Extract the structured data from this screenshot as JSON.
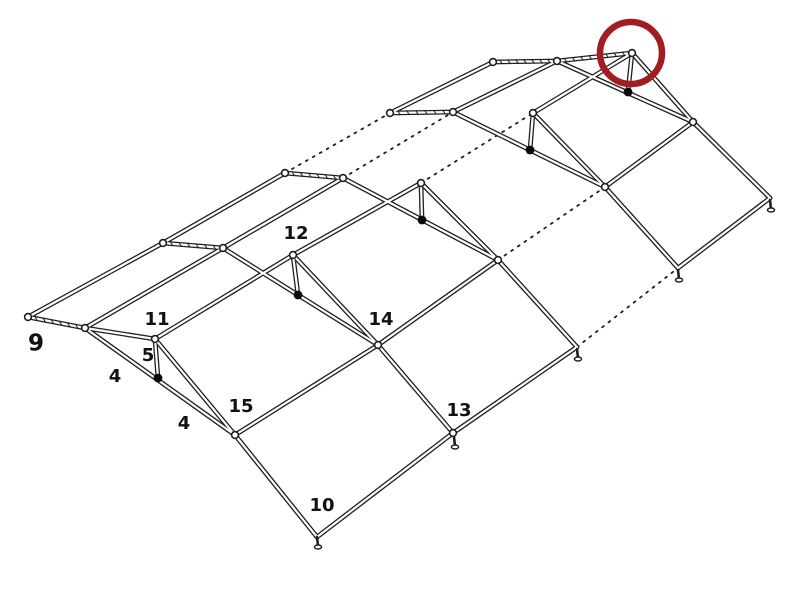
{
  "page": {
    "background": "#ffffff"
  },
  "diagram": {
    "type": "line-drawing",
    "description": "isometric assembly diagram of a pipe-frame tent skeleton with numbered part callouts and a red highlight circle on the far end fitting",
    "canvas": {
      "width": 800,
      "height": 600
    },
    "colors": {
      "line": "#1f1f1f",
      "pipe_core": "#ffffff",
      "connector_dot": "#0a0a0a",
      "label_text": "#111111",
      "highlight": "#a21d23",
      "background": "#ffffff"
    },
    "highlight_circle": {
      "cx": 631,
      "cy": 53,
      "r": 31,
      "stroke_width": 6.5
    },
    "part_labels": [
      {
        "text": "9",
        "x": 36,
        "y": 344,
        "size": 23
      },
      {
        "text": "11",
        "x": 157,
        "y": 320,
        "size": 18
      },
      {
        "text": "5",
        "x": 148,
        "y": 356,
        "size": 18
      },
      {
        "text": "4",
        "x": 115,
        "y": 377,
        "size": 18
      },
      {
        "text": "4",
        "x": 184,
        "y": 424,
        "size": 18
      },
      {
        "text": "15",
        "x": 241,
        "y": 407,
        "size": 18
      },
      {
        "text": "12",
        "x": 296,
        "y": 234,
        "size": 18
      },
      {
        "text": "14",
        "x": 381,
        "y": 320,
        "size": 18
      },
      {
        "text": "13",
        "x": 459,
        "y": 411,
        "size": 18
      },
      {
        "text": "10",
        "x": 322,
        "y": 506,
        "size": 18
      }
    ],
    "segments": [
      {
        "name": "back-eave-bay1",
        "x1": 28,
        "y1": 317,
        "x2": 163,
        "y2": 243,
        "style": "solid",
        "hatch": false
      },
      {
        "name": "back-eave-bay2",
        "x1": 163,
        "y1": 243,
        "x2": 285,
        "y2": 173,
        "style": "solid",
        "hatch": false
      },
      {
        "name": "back-eave-bay3",
        "x1": 285,
        "y1": 173,
        "x2": 390,
        "y2": 113,
        "style": "dotted",
        "hatch": false
      },
      {
        "name": "back-eave-bay4",
        "x1": 390,
        "y1": 113,
        "x2": 493,
        "y2": 62,
        "style": "solid",
        "hatch": false
      },
      {
        "name": "ridge-bay1",
        "x1": 85,
        "y1": 328,
        "x2": 223,
        "y2": 248,
        "style": "solid",
        "hatch": false
      },
      {
        "name": "ridge-bay2",
        "x1": 223,
        "y1": 248,
        "x2": 343,
        "y2": 178,
        "style": "solid",
        "hatch": false
      },
      {
        "name": "ridge-bay3",
        "x1": 343,
        "y1": 178,
        "x2": 453,
        "y2": 112,
        "style": "dotted",
        "hatch": false
      },
      {
        "name": "ridge-bay4",
        "x1": 453,
        "y1": 112,
        "x2": 557,
        "y2": 61,
        "style": "solid",
        "hatch": false
      },
      {
        "name": "purlin-bay1",
        "x1": 155,
        "y1": 339,
        "x2": 293,
        "y2": 255,
        "style": "solid",
        "hatch": false
      },
      {
        "name": "purlin-bay2",
        "x1": 293,
        "y1": 255,
        "x2": 421,
        "y2": 183,
        "style": "solid",
        "hatch": false
      },
      {
        "name": "purlin-bay3",
        "x1": 421,
        "y1": 183,
        "x2": 533,
        "y2": 113,
        "style": "dotted",
        "hatch": false
      },
      {
        "name": "purlin-bay4",
        "x1": 533,
        "y1": 113,
        "x2": 632,
        "y2": 53,
        "style": "solid",
        "hatch": false
      },
      {
        "name": "eave-girt-bay1",
        "x1": 235,
        "y1": 435,
        "x2": 378,
        "y2": 345,
        "style": "solid",
        "hatch": false
      },
      {
        "name": "eave-girt-bay2",
        "x1": 378,
        "y1": 345,
        "x2": 498,
        "y2": 260,
        "style": "solid",
        "hatch": false
      },
      {
        "name": "eave-girt-bay3",
        "x1": 498,
        "y1": 260,
        "x2": 605,
        "y2": 187,
        "style": "dotted",
        "hatch": false
      },
      {
        "name": "eave-girt-bay4",
        "x1": 605,
        "y1": 187,
        "x2": 693,
        "y2": 122,
        "style": "solid",
        "hatch": false
      },
      {
        "name": "foot-line-bay1",
        "x1": 317,
        "y1": 537,
        "x2": 453,
        "y2": 433,
        "style": "solid",
        "hatch": false
      },
      {
        "name": "foot-line-bay2",
        "x1": 453,
        "y1": 433,
        "x2": 577,
        "y2": 347,
        "style": "solid",
        "hatch": false
      },
      {
        "name": "foot-line-bay3",
        "x1": 577,
        "y1": 347,
        "x2": 678,
        "y2": 268,
        "style": "dotted",
        "hatch": false
      },
      {
        "name": "foot-line-bay4",
        "x1": 678,
        "y1": 268,
        "x2": 770,
        "y2": 198,
        "style": "solid",
        "hatch": false
      },
      {
        "name": "end-stub-st1",
        "x1": 28,
        "y1": 317,
        "x2": 85,
        "y2": 328,
        "style": "solid",
        "hatch": true
      },
      {
        "name": "back-rafter-st2",
        "x1": 163,
        "y1": 243,
        "x2": 223,
        "y2": 248,
        "style": "solid",
        "hatch": true
      },
      {
        "name": "back-rafter-st3",
        "x1": 285,
        "y1": 173,
        "x2": 343,
        "y2": 178,
        "style": "solid",
        "hatch": true
      },
      {
        "name": "back-rafter-st4",
        "x1": 390,
        "y1": 113,
        "x2": 453,
        "y2": 112,
        "style": "solid",
        "hatch": true
      },
      {
        "name": "back-rafter-st5",
        "x1": 493,
        "y1": 62,
        "x2": 557,
        "y2": 61,
        "style": "solid",
        "hatch": true
      },
      {
        "name": "end-cap-near",
        "x1": 85,
        "y1": 328,
        "x2": 155,
        "y2": 339,
        "style": "solid",
        "hatch": false
      },
      {
        "name": "end-cap-far",
        "x1": 557,
        "y1": 61,
        "x2": 632,
        "y2": 53,
        "style": "solid",
        "hatch": true
      },
      {
        "name": "rafter-st1",
        "x1": 85,
        "y1": 328,
        "x2": 235,
        "y2": 435,
        "style": "solid",
        "hatch": false
      },
      {
        "name": "rafter-st2",
        "x1": 223,
        "y1": 248,
        "x2": 378,
        "y2": 345,
        "style": "solid",
        "hatch": false
      },
      {
        "name": "rafter-st3",
        "x1": 343,
        "y1": 178,
        "x2": 498,
        "y2": 260,
        "style": "solid",
        "hatch": false
      },
      {
        "name": "rafter-st4",
        "x1": 453,
        "y1": 112,
        "x2": 605,
        "y2": 187,
        "style": "solid",
        "hatch": false
      },
      {
        "name": "rafter-st5",
        "x1": 557,
        "y1": 61,
        "x2": 693,
        "y2": 122,
        "style": "solid",
        "hatch": false
      },
      {
        "name": "upper-leg-st1",
        "x1": 155,
        "y1": 339,
        "x2": 235,
        "y2": 435,
        "style": "solid",
        "hatch": false
      },
      {
        "name": "upper-leg-st2",
        "x1": 293,
        "y1": 255,
        "x2": 378,
        "y2": 345,
        "style": "solid",
        "hatch": false
      },
      {
        "name": "upper-leg-st3",
        "x1": 421,
        "y1": 183,
        "x2": 498,
        "y2": 260,
        "style": "solid",
        "hatch": false
      },
      {
        "name": "upper-leg-st4",
        "x1": 533,
        "y1": 113,
        "x2": 605,
        "y2": 187,
        "style": "solid",
        "hatch": false
      },
      {
        "name": "upper-leg-st5",
        "x1": 632,
        "y1": 53,
        "x2": 693,
        "y2": 122,
        "style": "solid",
        "hatch": false
      },
      {
        "name": "lower-leg-st1",
        "x1": 235,
        "y1": 435,
        "x2": 317,
        "y2": 537,
        "style": "solid",
        "hatch": false
      },
      {
        "name": "lower-leg-st2",
        "x1": 378,
        "y1": 345,
        "x2": 453,
        "y2": 433,
        "style": "solid",
        "hatch": false
      },
      {
        "name": "lower-leg-st3",
        "x1": 498,
        "y1": 260,
        "x2": 577,
        "y2": 347,
        "style": "solid",
        "hatch": false
      },
      {
        "name": "lower-leg-st4",
        "x1": 605,
        "y1": 187,
        "x2": 678,
        "y2": 268,
        "style": "solid",
        "hatch": false
      },
      {
        "name": "lower-leg-st5",
        "x1": 693,
        "y1": 122,
        "x2": 770,
        "y2": 198,
        "style": "solid",
        "hatch": false
      },
      {
        "name": "brace-st1",
        "x1": 155,
        "y1": 339,
        "x2": 158,
        "y2": 378,
        "style": "solid",
        "hatch": false
      },
      {
        "name": "brace-st2",
        "x1": 293,
        "y1": 255,
        "x2": 298,
        "y2": 295,
        "style": "solid",
        "hatch": false
      },
      {
        "name": "brace-st3",
        "x1": 421,
        "y1": 183,
        "x2": 422,
        "y2": 220,
        "style": "solid",
        "hatch": false
      },
      {
        "name": "brace-st4",
        "x1": 533,
        "y1": 113,
        "x2": 530,
        "y2": 150,
        "style": "solid",
        "hatch": false
      },
      {
        "name": "brace-st5",
        "x1": 632,
        "y1": 53,
        "x2": 628,
        "y2": 92,
        "style": "solid",
        "hatch": false
      }
    ],
    "joints": [
      [
        28,
        317
      ],
      [
        85,
        328
      ],
      [
        155,
        339
      ],
      [
        163,
        243
      ],
      [
        223,
        248
      ],
      [
        285,
        173
      ],
      [
        343,
        178
      ],
      [
        293,
        255
      ],
      [
        421,
        183
      ],
      [
        390,
        113
      ],
      [
        453,
        112
      ],
      [
        533,
        113
      ],
      [
        493,
        62
      ],
      [
        557,
        61
      ],
      [
        632,
        53
      ],
      [
        235,
        435
      ],
      [
        378,
        345
      ],
      [
        498,
        260
      ],
      [
        605,
        187
      ],
      [
        693,
        122
      ],
      [
        453,
        433
      ]
    ],
    "connector_dots": [
      [
        158,
        378
      ],
      [
        298,
        295
      ],
      [
        422,
        220
      ],
      [
        530,
        150
      ],
      [
        628,
        92
      ]
    ],
    "feet": [
      [
        317,
        537
      ],
      [
        454,
        437
      ],
      [
        577,
        349
      ],
      [
        678,
        270
      ],
      [
        770,
        200
      ]
    ]
  }
}
